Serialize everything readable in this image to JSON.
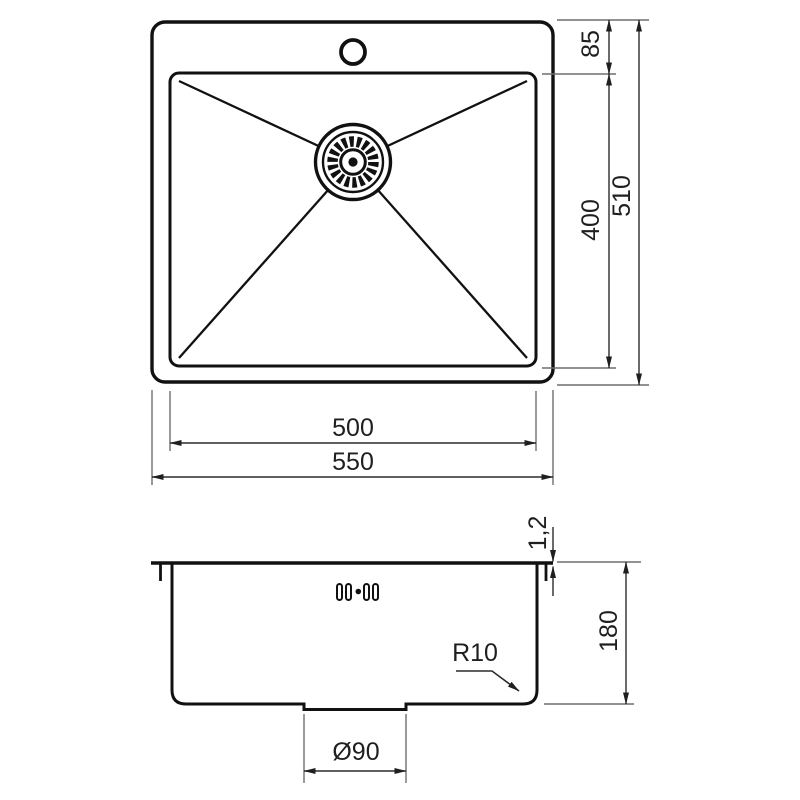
{
  "top_view": {
    "labels": {
      "rim_to_basin_offset": "85",
      "basin_length": "400",
      "overall_depth": "510",
      "basin_width": "500",
      "overall_width": "550"
    }
  },
  "side_view": {
    "labels": {
      "rim_thickness": "1,2",
      "bowl_depth": "180",
      "corner_radius": "R10",
      "drain_diameter": "Ø90"
    }
  },
  "colors": {
    "object_line": "#111111",
    "dimension_line": "#2b2b2b",
    "extension_line": "#6e6e6e",
    "text": "#1f1f1f",
    "background": "#ffffff"
  }
}
